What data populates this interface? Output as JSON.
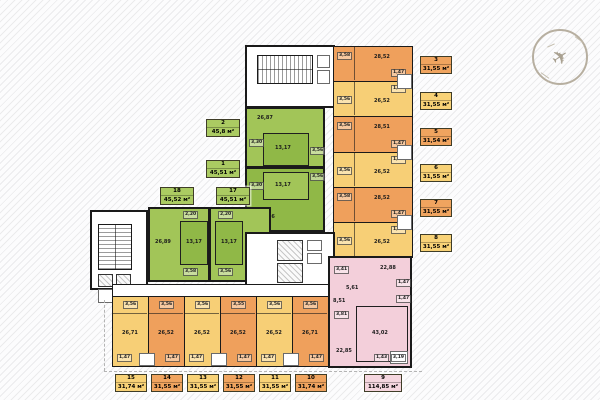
{
  "colors": {
    "orange": "#efa05c",
    "yellow": "#f7cf76",
    "green": "#a2c558",
    "green_dark": "#90b847",
    "pink": "#f3cfda",
    "wall": "#1a1a1a"
  },
  "compass": {
    "icon": "airplane-north-indicator"
  },
  "units": [
    {
      "num": "1",
      "area": "45,51 м²",
      "rooms": {
        "bedroom": "13,17",
        "living": "26,86",
        "h1": "3,30",
        "h2": "3,56"
      }
    },
    {
      "num": "2",
      "area": "45,8 м²",
      "rooms": {
        "living": "26,87",
        "bedroom": "13,17",
        "h1": "3,30",
        "h2": "3,56"
      }
    },
    {
      "num": "3",
      "area": "31,55 м²",
      "rooms": {
        "main": "28,52",
        "hall": "3,58",
        "bath": "1,47"
      }
    },
    {
      "num": "4",
      "area": "31,55 м²",
      "rooms": {
        "main": "26,52",
        "hall": "3,56",
        "bath": "1,47"
      }
    },
    {
      "num": "5",
      "area": "31,54 м²",
      "rooms": {
        "main": "28,51",
        "hall": "3,56",
        "bath": "1,47"
      }
    },
    {
      "num": "6",
      "area": "31,55 м²",
      "rooms": {
        "main": "26,52",
        "hall": "3,56",
        "bath": "1,47"
      }
    },
    {
      "num": "7",
      "area": "31,55 м²",
      "rooms": {
        "main": "28,52",
        "hall": "3,58",
        "bath": "1,47"
      }
    },
    {
      "num": "8",
      "area": "31,55 м²",
      "rooms": {
        "main": "26,52",
        "hall": "3,56",
        "bath": "1,47"
      }
    },
    {
      "num": "9",
      "area": "114,85 м²",
      "rooms": {
        "hall": "8,51",
        "r1": "22,88",
        "r2": "43,02",
        "r3": "22,85",
        "h1": "3,41",
        "h2": "5,61",
        "h3": "3,81",
        "b1": "1,47",
        "b2": "1,47",
        "b3": "1,43",
        "loggia": "3,19"
      }
    },
    {
      "num": "10",
      "area": "31,74 м²",
      "rooms": {
        "main": "26,71",
        "hall": "3,56",
        "bath": "1,47"
      }
    },
    {
      "num": "11",
      "area": "31,55 м²",
      "rooms": {
        "main": "26,52",
        "hall": "3,56",
        "bath": "1,47"
      }
    },
    {
      "num": "12",
      "area": "31,55 м²",
      "rooms": {
        "main": "26,52",
        "hall": "3,55",
        "bath": "1,47"
      }
    },
    {
      "num": "13",
      "area": "31,55 м²",
      "rooms": {
        "main": "26,52",
        "hall": "3,56",
        "bath": "1,47"
      }
    },
    {
      "num": "14",
      "area": "31,55 м²",
      "rooms": {
        "main": "26,52",
        "hall": "3,56",
        "bath": "1,47"
      }
    },
    {
      "num": "15",
      "area": "31,74 м²",
      "rooms": {
        "main": "26,71",
        "hall": "3,56",
        "bath": "1,47"
      }
    },
    {
      "num": "17",
      "area": "45,51 м²",
      "rooms": {
        "bedroom": "13,17",
        "living": "26,88",
        "h1": "2,20",
        "h2": "3,56"
      }
    },
    {
      "num": "18",
      "area": "45,52 м²",
      "rooms": {
        "living": "26,89",
        "bedroom": "13,17",
        "h1": "2,20",
        "h2": "3,58"
      }
    }
  ]
}
